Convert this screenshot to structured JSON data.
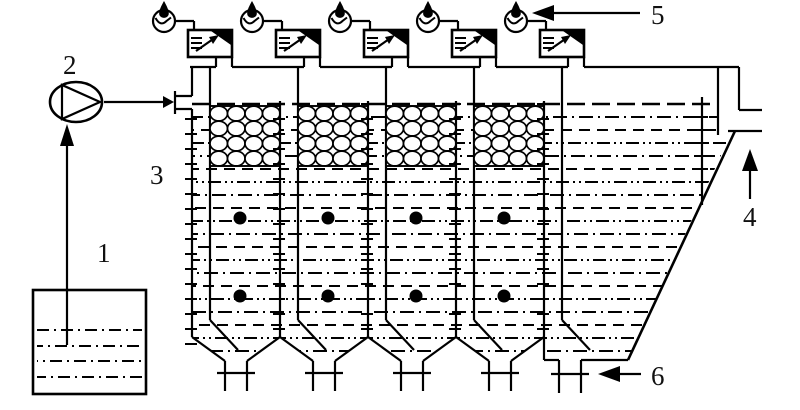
{
  "figure": {
    "kind": "process-flow schematic (black line art)",
    "description": "Four-stage baffled reactor with packing media chambers, feed tank, feed pump, gas meters with water-seal boxes on top, lamella settling zone with effluent outlet, and hopper sludge drains",
    "colors": {
      "line": "#000000",
      "background": "#ffffff"
    }
  },
  "labels": {
    "feed_tank": "1",
    "feed_pump": "2",
    "reactor_vessel": "3",
    "effluent_outlet": "4",
    "gas_meter": "5",
    "sludge_drain": "6"
  },
  "icons": [
    "pump-icon",
    "gas-meter-drop-icon",
    "water-seal-box-icon",
    "packing-media-icon",
    "sampling-port-icon",
    "valve-tick-icon",
    "flow-arrow-icon"
  ]
}
